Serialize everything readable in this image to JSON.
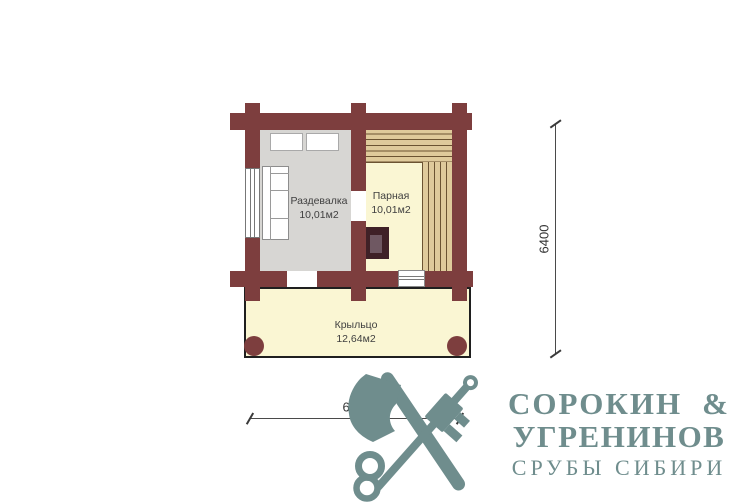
{
  "plan": {
    "rooms": [
      {
        "name": "Раздевалка",
        "area": "10,01м2"
      },
      {
        "name": "Парная",
        "area": "10,01м2"
      },
      {
        "name": "Крыльцо",
        "area": "12,64м2"
      }
    ],
    "dimensions": {
      "vertical": "6400",
      "horizontal": "6000"
    }
  },
  "logo": {
    "line1_name": "СОРОКИН",
    "line1_amp": "&",
    "line2": "УГРЕНИНОВ",
    "line3": "СРУБЫ СИБИРИ"
  },
  "colors": {
    "wall": "#7d3e3e",
    "floor_dressing": "#d7d6d3",
    "floor_cream": "#faf6d3",
    "bench": "#dfca9b",
    "bench_line": "#6b5332",
    "stove_outer": "#3f2127",
    "stove_inner": "#6f5862",
    "brand": "#6f8d8d",
    "dimension": "#4a4a4a"
  }
}
